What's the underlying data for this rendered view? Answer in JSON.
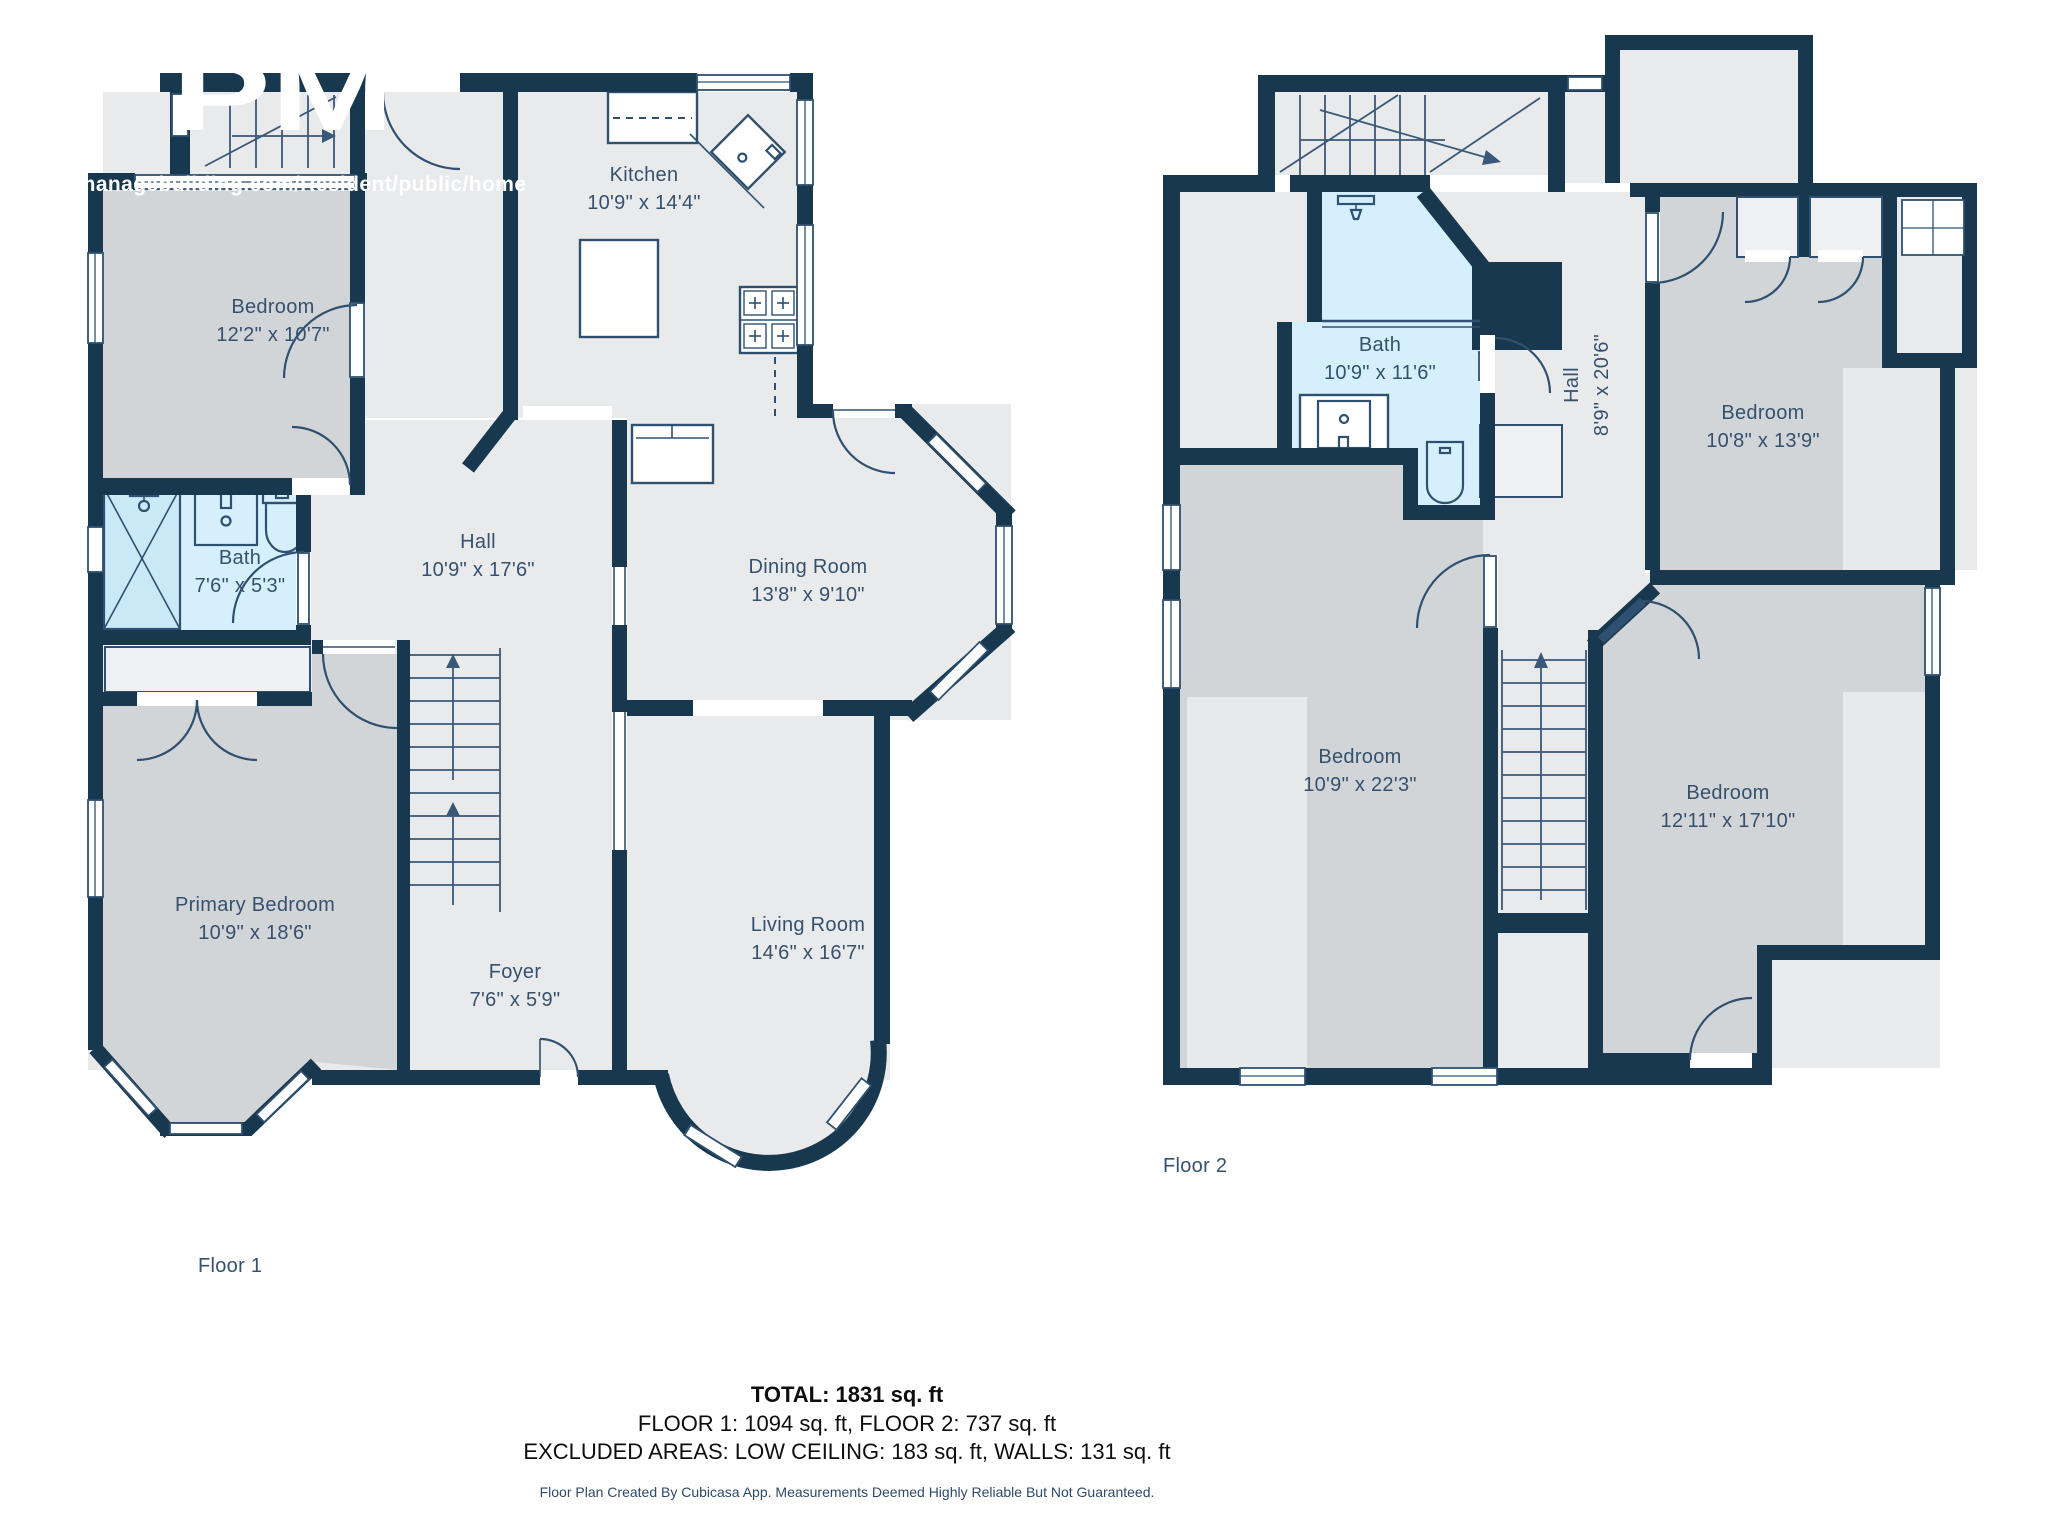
{
  "watermark": {
    "url_text": "perty-managebuilding.com/Resident/public/home",
    "logo_text": "PM"
  },
  "floor1": {
    "label": "Floor 1",
    "rooms": {
      "kitchen": {
        "name": "Kitchen",
        "dims": "10'9\" x 14'4\""
      },
      "bedroom": {
        "name": "Bedroom",
        "dims": "12'2\" x 10'7\""
      },
      "bath": {
        "name": "Bath",
        "dims": "7'6\" x 5'3\""
      },
      "hall": {
        "name": "Hall",
        "dims": "10'9\" x 17'6\""
      },
      "dining": {
        "name": "Dining Room",
        "dims": "13'8\" x 9'10\""
      },
      "primary": {
        "name": "Primary Bedroom",
        "dims": "10'9\" x 18'6\""
      },
      "foyer": {
        "name": "Foyer",
        "dims": "7'6\" x 5'9\""
      },
      "living": {
        "name": "Living Room",
        "dims": "14'6\" x 16'7\""
      }
    }
  },
  "floor2": {
    "label": "Floor 2",
    "rooms": {
      "bath": {
        "name": "Bath",
        "dims": "10'9\" x 11'6\""
      },
      "hall": {
        "name": "Hall",
        "dims": "8'9\" x 20'6\""
      },
      "bedroom_tr": {
        "name": "Bedroom",
        "dims": "10'8\" x 13'9\""
      },
      "bedroom_left": {
        "name": "Bedroom",
        "dims": "10'9\" x 22'3\""
      },
      "bedroom_br": {
        "name": "Bedroom",
        "dims": "12'11\" x 17'10\""
      }
    }
  },
  "summary": {
    "total": "TOTAL: 1831 sq. ft",
    "floors": "FLOOR 1: 1094 sq. ft, FLOOR 2: 737 sq. ft",
    "excluded": "EXCLUDED AREAS: LOW CEILING: 183 sq. ft, WALLS: 131 sq. ft",
    "disclaimer": "Floor Plan Created By Cubicasa App. Measurements Deemed Highly Reliable But Not Guaranteed."
  },
  "colors": {
    "wall": "#18384F",
    "room_light": "#E9EAEC",
    "room_gray": "#D2D5D8",
    "bath_blue": "#D6EFFC",
    "label_text": "#35516E"
  }
}
